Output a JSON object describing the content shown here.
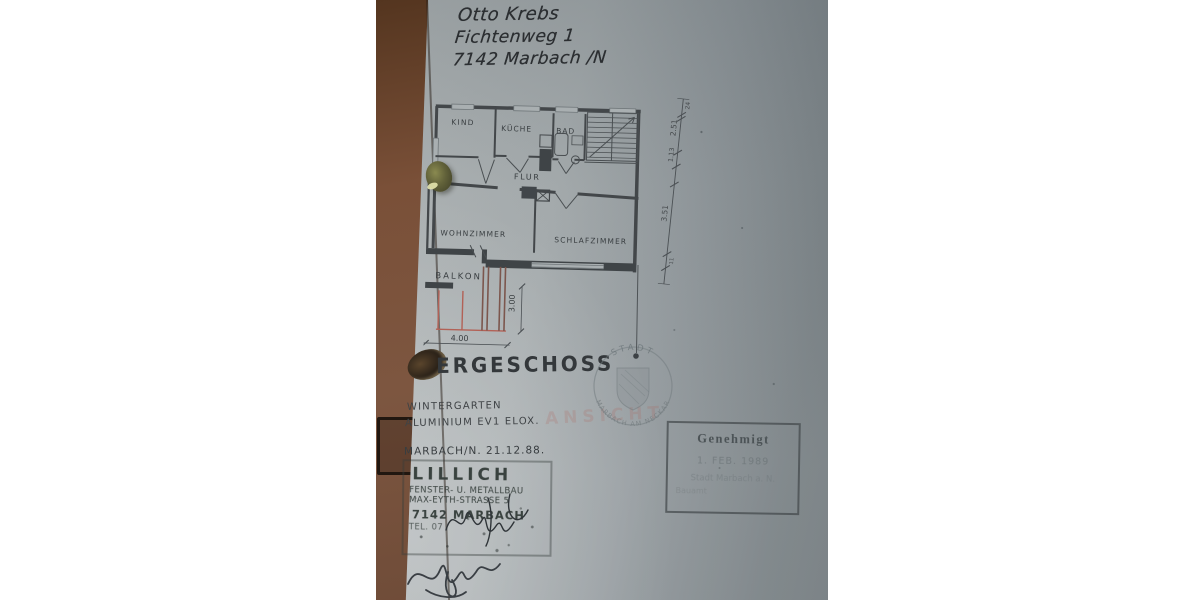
{
  "doc": {
    "address": {
      "line1": "Otto Krebs",
      "line2": "Fichtenweg 1",
      "line3": "7142 Marbach /N"
    },
    "plan": {
      "rooms": {
        "kind": "KIND",
        "kueche": "KÜCHE",
        "bad": "BAD",
        "flur": "FLUR",
        "wohnzimmer": "WOHNZIMMER",
        "schlafzimmer": "SCHLAFZIMMER",
        "balkon": "BALKON"
      },
      "dims": {
        "width": "4.00",
        "depth": "3.00",
        "chain_top": "24",
        "seg1": "2.51",
        "seg2": "1.13",
        "seg3": "3.51",
        "chain_bottom": "11"
      }
    },
    "title": "ERGESCHOSS",
    "notes": {
      "line1": "WINTERGARTEN",
      "line2": "ALUMINIUM EV1 ELOX."
    },
    "place_date": "MARBACH/N. 21.12.88.",
    "maker_stamp": {
      "name": "LILLICH",
      "line1": "FENSTER- U. METALLBAU",
      "line2": "MAX-EYTH-STRASSE 5",
      "line3": "7142 MARBACH",
      "line4": "TEL. 07"
    },
    "city_stamp": {
      "top": "STADT",
      "bottom": "MARBACH AM NECKAR"
    },
    "approval": {
      "title": "Genehmigt",
      "date": "1. FEB. 1989",
      "authority": "Stadt Marbach a. N.",
      "office": "Bauamt"
    },
    "overprint": "ANSICHT"
  },
  "colors": {
    "paper": "#a7adaf",
    "ink": "#3b3f42",
    "red_line": "#b26156",
    "stamp_gray": "#7d868a",
    "background_brown": "#734c35",
    "approval_ink": "#5f686d"
  }
}
